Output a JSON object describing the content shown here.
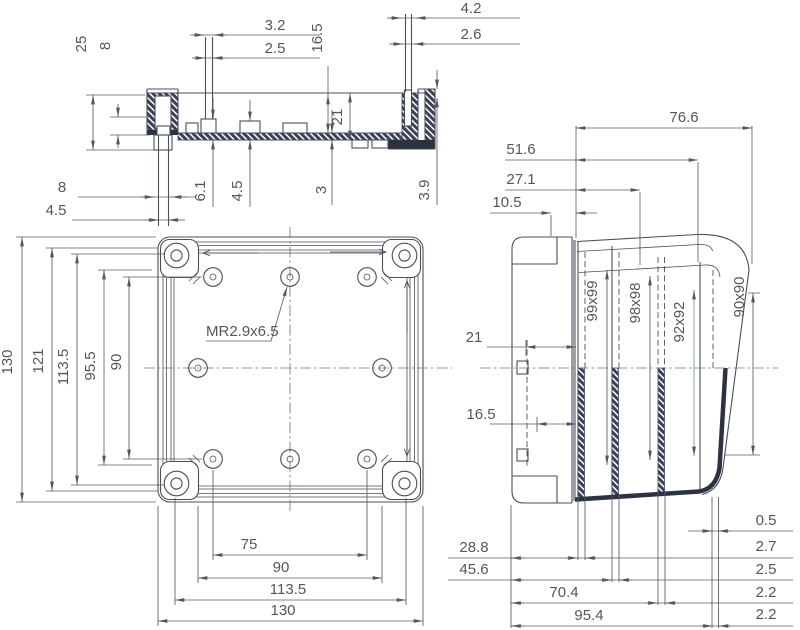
{
  "views": {
    "section": {
      "d25": "25",
      "d8_left": "8",
      "d3_2": "3.2",
      "d2_5": "2.5",
      "d16_5": "16.5",
      "d4_2": "4.2",
      "d2_6": "2.6",
      "d21": "21",
      "d8_bottom": "8",
      "d4_5_bottom": "4.5",
      "d6_1": "6.1",
      "d4_5_mid": "4.5",
      "d3": "3",
      "d3_9": "3.9"
    },
    "bottom": {
      "d130_left": "130",
      "d121": "121",
      "d113_5_left": "113.5",
      "d95_5": "95.5",
      "d90_left": "90",
      "thread_callout": "MR2.9x6.5",
      "d75": "75",
      "d90_bottom": "90",
      "d113_5_bottom": "113.5",
      "d130_bottom": "130"
    },
    "side": {
      "d76_6": "76.6",
      "d51_6": "51.6",
      "d27_1": "27.1",
      "d10_5": "10.5",
      "d21": "21",
      "d16_5": "16.5",
      "d99x99": "99x99",
      "d98x98": "98x98",
      "d92x92": "92x92",
      "d90x90": "90x90",
      "d28_8": "28.8",
      "d45_6": "45.6",
      "d70_4": "70.4",
      "d95_4": "95.4",
      "t0_5": "0.5",
      "t2_7": "2.7",
      "t2_5": "2.5",
      "t2_2a": "2.2",
      "t2_2b": "2.2"
    }
  },
  "colors": {
    "line": "#4a4f58",
    "dim": "#5a5c63",
    "text": "#54565c",
    "hatch": "#3a4158",
    "accent": "#6e9996",
    "shade": "#9aa2ac",
    "background": "#ffffff"
  }
}
